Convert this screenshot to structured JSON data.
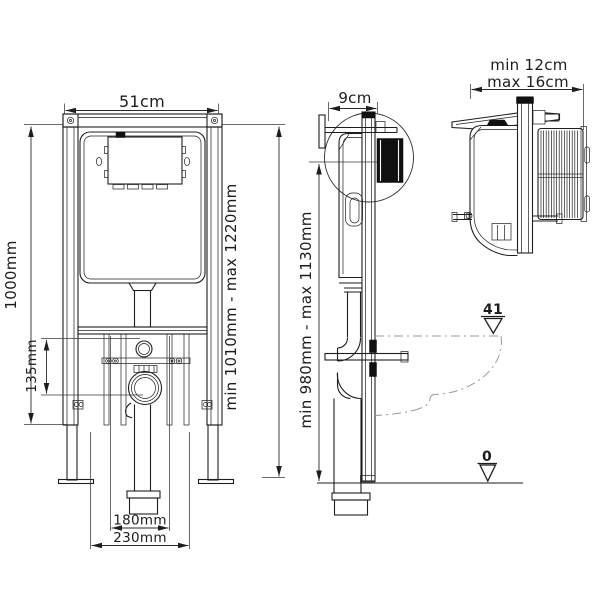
{
  "front_view": {
    "width_label": "51cm",
    "height_label": "1000mm",
    "outlet_offset_label": "135mm",
    "install_range_label": "min 1010mm - max 1220mm",
    "drain_width_label": "180mm",
    "base_width_label": "230mm"
  },
  "side_view": {
    "depth_label": "9cm",
    "control_range_label": "min 980mm - max 1130mm",
    "seat_level_label": "41",
    "floor_level_label": "0"
  },
  "detail_view": {
    "depth_min_label": "min 12cm",
    "depth_max_label": "max 16cm"
  },
  "colors": {
    "line": "#1e1e1e",
    "bowl_outline": "#9b9b9b",
    "background": "#ffffff"
  }
}
